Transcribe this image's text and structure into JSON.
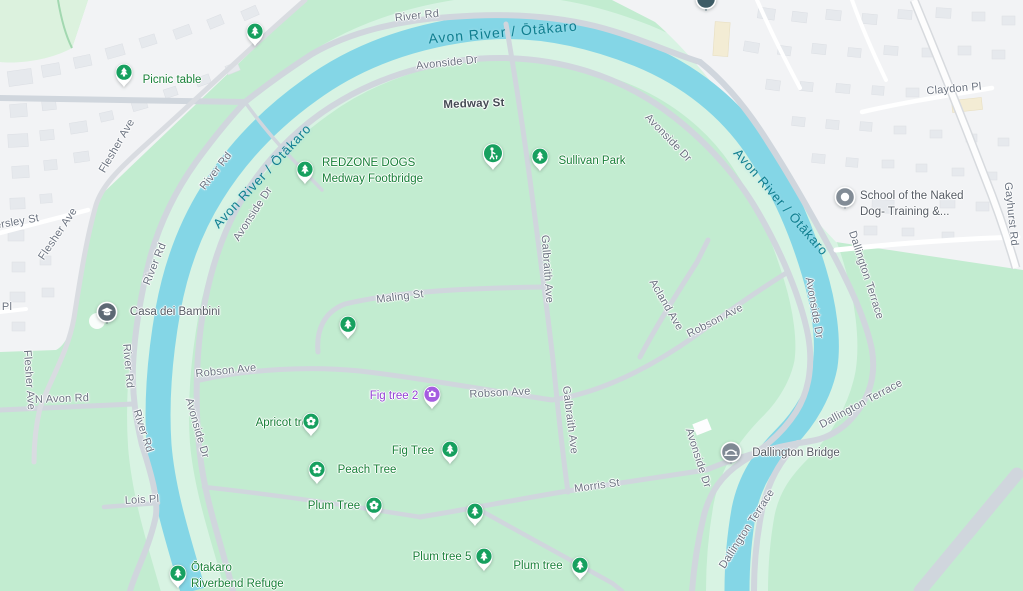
{
  "river": {
    "name": "Avon River / Ōtākaro"
  },
  "roads": {
    "river_rd": "River Rd",
    "medway_st": "Medway St",
    "avonside_dr": "Avonside Dr",
    "flesher_ave": "Flesher Ave",
    "ersley_st": "ersley St",
    "pl": "Pl",
    "n_avon_rd": "N Avon Rd",
    "lois_pl": "Lois Pl",
    "maling_st": "Maling St",
    "robson_ave": "Robson Ave",
    "galbraith_ave": "Galbraith Ave",
    "acland_ave": "Acland Ave",
    "morris_st": "Morris St",
    "claydon_pl": "Claydon Pl",
    "gayhurst_rd": "Gayhurst Rd",
    "dallington_terrace": "Dallington Terrace"
  },
  "pois": {
    "picnic_table": {
      "label": "Picnic table"
    },
    "redzone_dogs": {
      "line1": "REDZONE DOGS",
      "line2": "Medway Footbridge"
    },
    "sullivan_park": {
      "label": "Sullivan Park"
    },
    "casa_dei_bambini": {
      "label": "Casa dei Bambini"
    },
    "school_of_the_naked_dog": {
      "line1": "School of the Naked",
      "line2": "Dog- Training &..."
    },
    "fig_tree_2": {
      "label": "Fig tree 2"
    },
    "apricot_tree": {
      "label": "Apricot tree"
    },
    "fig_tree": {
      "label": "Fig Tree"
    },
    "peach_tree": {
      "label": "Peach Tree"
    },
    "plum_tree_big": {
      "label": "Plum Tree"
    },
    "plum_tree_5": {
      "label": "Plum tree 5"
    },
    "plum_tree_small": {
      "label": "Plum tree"
    },
    "dallington_bridge": {
      "label": "Dallington Bridge"
    },
    "otakaro_riverbend_refuge": {
      "line1": "Ōtakaro",
      "line2": "Riverbend Refuge"
    }
  },
  "colors": {
    "park_green": "#c2ecd0",
    "floodplain_mint": "#d8f3e3",
    "river_blue": "#84d6e6",
    "residential": "#f2f3f5",
    "building": "#e6e9ed",
    "road_gray": "#d0d6dd",
    "poi_label_green": "#188038",
    "poi_label_purple": "#9340d4",
    "river_label_teal": "#0f7e8f",
    "marker_green": "#17a05f",
    "marker_purple": "#a55ce0",
    "marker_gray": "#7f8994"
  }
}
